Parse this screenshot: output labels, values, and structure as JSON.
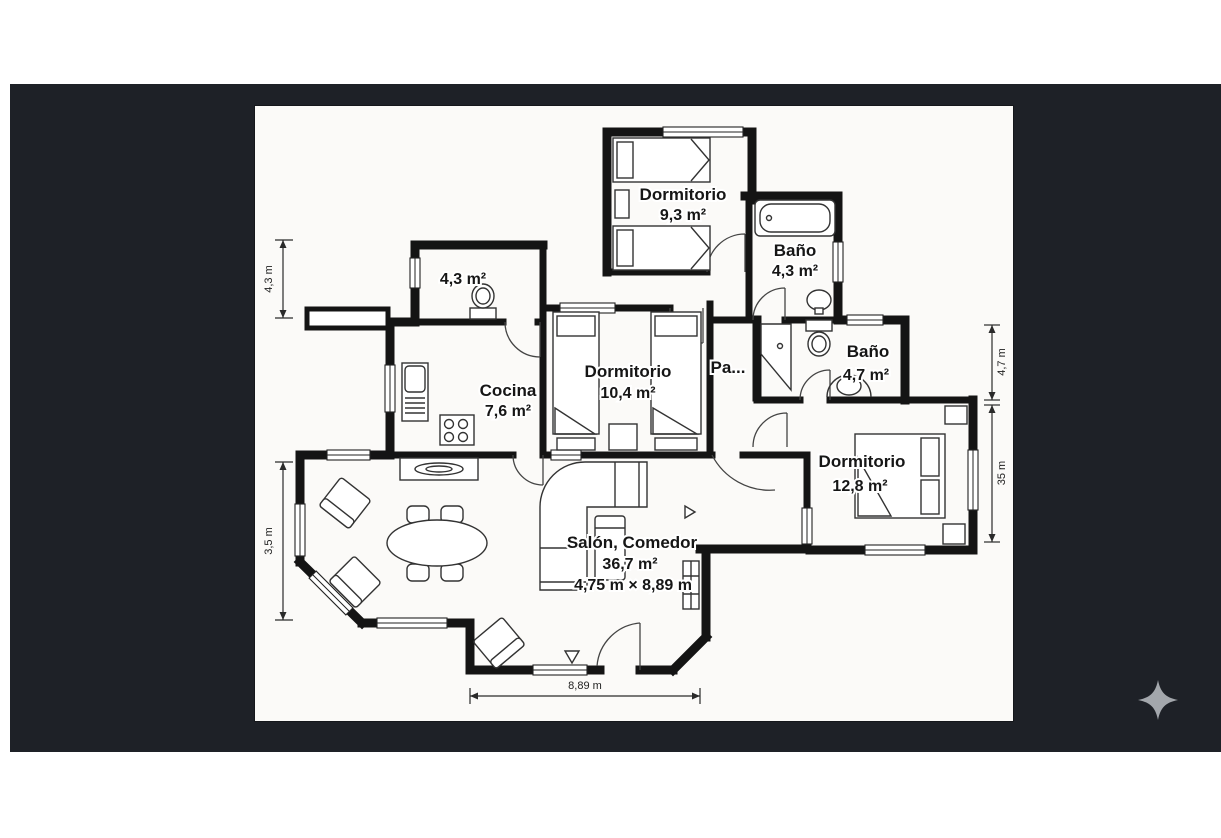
{
  "fp": {
    "rooms": {
      "bedroom_top": {
        "name": "Dormitorio",
        "area": "9,3 m²"
      },
      "bath_top": {
        "name": "Baño",
        "area": "4,3 m²"
      },
      "wc": {
        "area": "4,3 m²"
      },
      "kitchen": {
        "name": "Cocina",
        "area": "7,6 m²"
      },
      "bedroom_mid": {
        "name": "Dormitorio",
        "area": "10,4 m²"
      },
      "hall": {
        "name": "Pa..."
      },
      "bath_right": {
        "name": "Baño",
        "area": "4,7 m²"
      },
      "bedroom_right": {
        "name": "Dormitorio",
        "area": "12,8 m²"
      },
      "living": {
        "name": "Salón, Comedor",
        "area": "36,7 m²",
        "size": "4,75 m × 8,89 m"
      }
    },
    "dims": {
      "left_top": "4,3 m",
      "left_bottom": "3,5 m",
      "right_top": "4,7 m",
      "right_bottom": "35 m",
      "bottom": "8,89 m"
    },
    "colors": {
      "backdrop": "#1e2127",
      "canvas": "#fbfaf8",
      "walls": "#141414",
      "sparkle": "#a3a7ac"
    }
  },
  "overlay": {
    "sparkle_icon": "sparkle"
  }
}
